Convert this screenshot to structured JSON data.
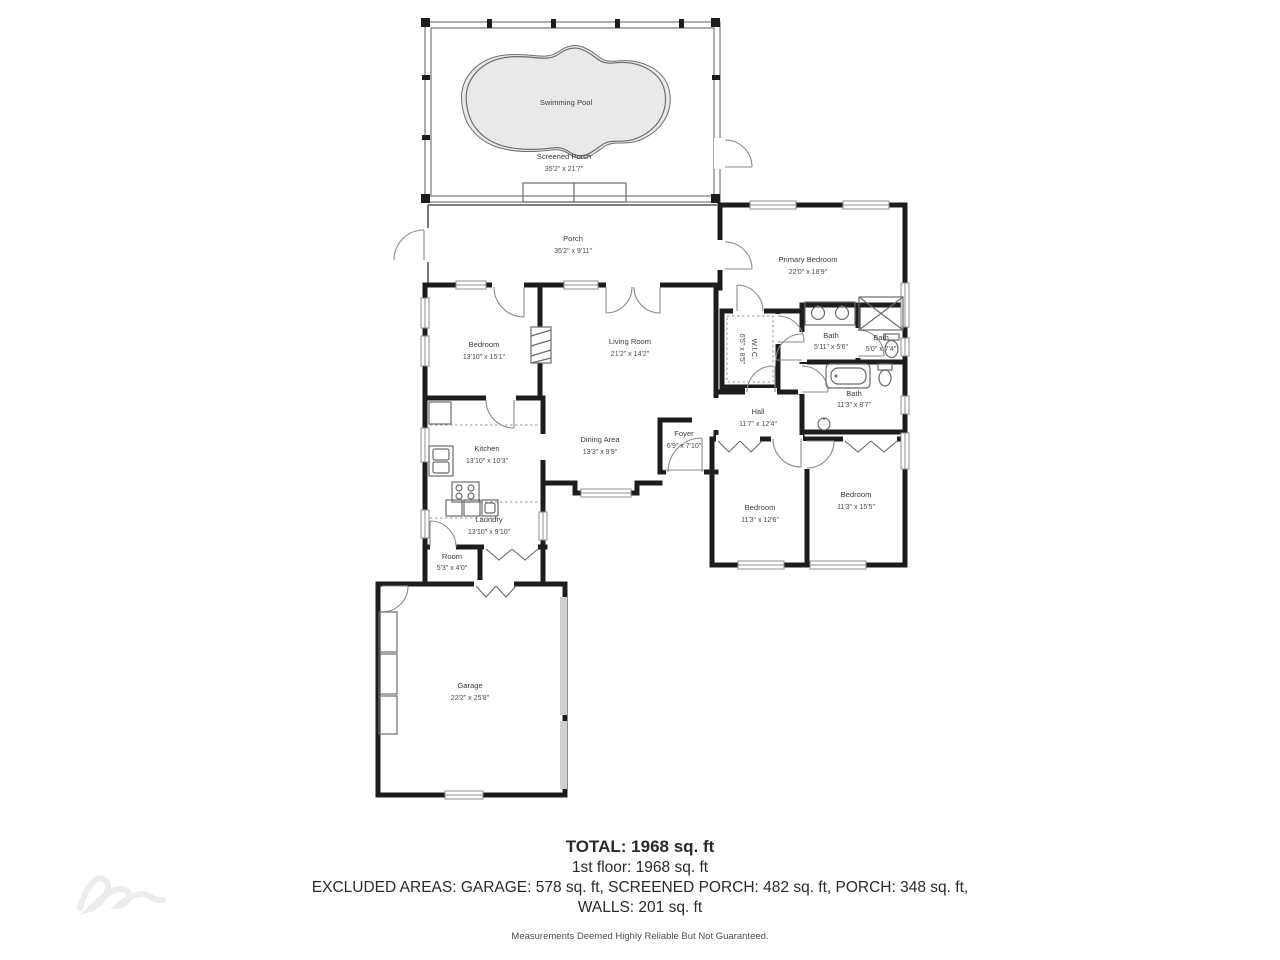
{
  "rooms": {
    "swimming_pool": {
      "label": "Swimming Pool"
    },
    "screened_porch": {
      "label": "Screened Porch",
      "dims": "35'2\" x 21'7\""
    },
    "porch": {
      "label": "Porch",
      "dims": "35'2\" x 9'11\""
    },
    "primary_bedroom": {
      "label": "Primary Bedroom",
      "dims": "22'0\" x 18'9\""
    },
    "bedroom_left": {
      "label": "Bedroom",
      "dims": "13'10\" x 15'1\""
    },
    "living_room": {
      "label": "Living Room",
      "dims": "21'2\" x 14'2\""
    },
    "wic": {
      "label": "W.I.C.",
      "dims": "6'5\" x 8'5\""
    },
    "bath_vanity": {
      "label": "Bath",
      "dims": "5'11\" x 5'6\""
    },
    "bath_shower": {
      "label": "Bath",
      "dims": "5'0\" x 7'4\""
    },
    "bath_hall": {
      "label": "Bath",
      "dims": "11'3\" x 8'7\""
    },
    "hall": {
      "label": "Hall",
      "dims": "11'7\" x 12'4\""
    },
    "kitchen": {
      "label": "Kitchen",
      "dims": "13'10\" x 10'3\""
    },
    "dining_area": {
      "label": "Dining Area",
      "dims": "13'3\" x 9'9\""
    },
    "foyer": {
      "label": "Foyer",
      "dims": "6'9\" x 7'10\""
    },
    "bedroom_mid": {
      "label": "Bedroom",
      "dims": "11'3\" x 12'6\""
    },
    "bedroom_right": {
      "label": "Bedroom",
      "dims": "11'3\" x 15'5\""
    },
    "laundry": {
      "label": "Laundry",
      "dims": "13'10\" x 9'10\""
    },
    "room": {
      "label": "Room",
      "dims": "5'3\" x 4'0\""
    },
    "garage": {
      "label": "Garage",
      "dims": "22'2\" x 25'8\""
    }
  },
  "summary": {
    "total": "TOTAL: 1968 sq. ft",
    "first_floor": "1st floor: 1968 sq. ft",
    "excluded": "EXCLUDED AREAS: GARAGE: 578 sq. ft, SCREENED PORCH: 482 sq. ft, PORCH: 348 sq. ft,",
    "walls": "WALLS: 201 sq. ft",
    "disclaimer": "Measurements Deemed Highly Reliable But Not Guaranteed."
  },
  "colors": {
    "wall": "#1d1d1d",
    "pool_fill": "#e9e9e9",
    "garage_door": "#cfcfcf"
  }
}
